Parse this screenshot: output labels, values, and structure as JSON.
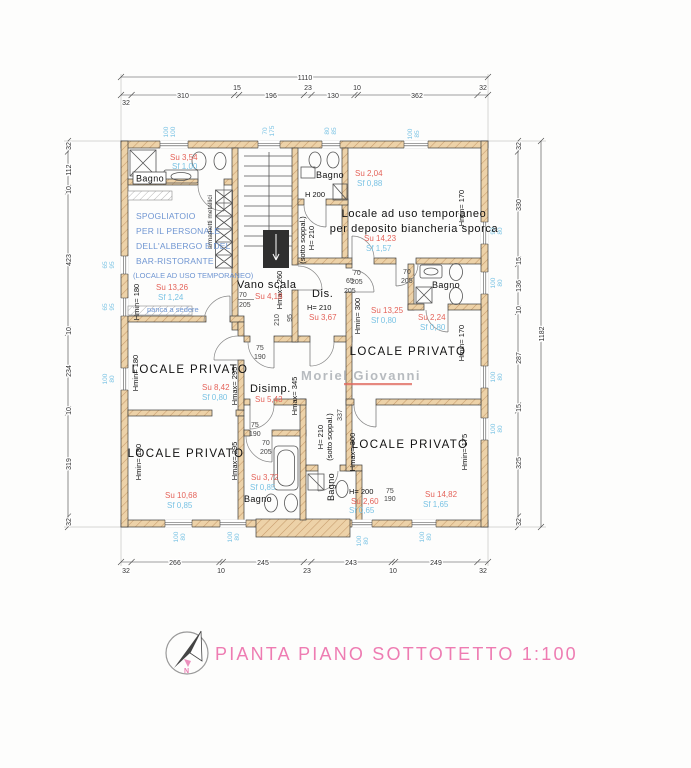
{
  "colors": {
    "wall_fill": "#edd2a8",
    "wall_hatch": "#c59a6a",
    "su_red": "#e4635a",
    "sf_cyan": "#7ac3e4",
    "desc_blue": "#7096d2",
    "title_pink": "#ee7cb2",
    "watermark_gray": "#a6abb1"
  },
  "title": "PIANTA PIANO SOTTOTETTO 1:100",
  "watermark": "Moriel Giovanni",
  "logo_n": "N",
  "dims": {
    "top": {
      "overall": "1110",
      "segs": [
        "32",
        "310",
        "15",
        "196",
        "23",
        "130",
        "10",
        "362",
        "32"
      ]
    },
    "bottom": {
      "segs": [
        "32",
        "266",
        "10",
        "245",
        "23",
        "243",
        "10",
        "249",
        "32"
      ]
    },
    "left": {
      "segs": [
        "32",
        "112",
        "10",
        "423",
        "10",
        "234",
        "10",
        "319",
        "32"
      ]
    },
    "right": {
      "overall": "1182",
      "segs": [
        "32",
        "330",
        "15",
        "136",
        "10",
        "287",
        "15",
        "325",
        "32"
      ]
    }
  },
  "rooms": {
    "bagno_tl": {
      "name": "Bagno",
      "su": "Su 3,54",
      "sf": "Sf 1,00"
    },
    "spogliatoio": {
      "line1": "SPOGLIATOIO",
      "line2": "PER IL PERSONALE",
      "line3": "DELL'ALBERGO E DEL",
      "line4": "BAR-RISTORANTE",
      "line5": "(LOCALE AD USO TEMPORANEO)",
      "su": "Su 13,26",
      "sf": "Sf 1,24",
      "bench": "panca a sedere",
      "lockers": "armadietti metallici",
      "hmin": "Hmin= 180",
      "hmax": "Hmax= 260"
    },
    "vano_scala": {
      "name": "Vano scala",
      "su": "Su 4,18"
    },
    "dis": {
      "name": "Dis.",
      "h": "H= 210",
      "su": "Su 3,67"
    },
    "bagno_tc": {
      "name": "Bagno",
      "h": "H 200",
      "su": "Su 2,04",
      "sf": "Sf 0,88"
    },
    "corridoio_tc": {
      "h": "H= 210",
      "note": "(sotto soppal.)"
    },
    "deposito": {
      "line1": "Locale ad uso temporaneo",
      "line2": "per deposito biancheria sporca",
      "su": "Su 14,23",
      "sf": "Sf 1,57",
      "hmin": "Hmin= 170"
    },
    "bagno_r": {
      "name": "Bagno",
      "su": "Su 2,24",
      "sf": "Sf 0,80"
    },
    "locale_rm": {
      "name": "LOCALE PRIVATO",
      "su": "Su 13,25",
      "sf": "Sf 0,80",
      "hmin_left": "Hmin= 300",
      "hmin_right": "Hmin= 170"
    },
    "locale_ml": {
      "name": "LOCALE PRIVATO",
      "su": "Su 8,42",
      "sf": "Sf 0,80",
      "hmin": "Hmin= 180",
      "hmax": "Hmax= 295"
    },
    "disimp": {
      "name": "Disimp.",
      "su": "Su 5,43",
      "hmax": "Hmax= 345"
    },
    "locale_bl": {
      "name": "LOCALE PRIVATO",
      "su": "Su 10,68",
      "sf": "Sf 0,85",
      "hmin": "Hmin= 180",
      "hmax": "Hmax= 295"
    },
    "bagno_bc": {
      "name": "Bagno",
      "su": "Su 3,72",
      "sf": "Sf 0,85"
    },
    "bagno_br": {
      "name": "Bagno",
      "h": "H= 200",
      "su": "Su 2,60",
      "sf": "Sf 0,65"
    },
    "locale_br": {
      "name": "LOCALE PRIVATO",
      "su": "Su 14,82",
      "sf": "Sf 1,65",
      "hmax": "Hmax= 300",
      "hmin": "Hmin= 175",
      "corr_h": "H= 210",
      "corr_note": "(sotto soppal.)",
      "corr_dim": "337"
    }
  },
  "doors": {
    "d70x205": {
      "w": "70",
      "h": "205"
    },
    "d75x190": {
      "w": "75",
      "h": "190"
    },
    "d65x205": {
      "w": "65",
      "h": "205"
    },
    "d95x210": {
      "w": "95",
      "h": "210"
    }
  },
  "windows": {
    "w100x100": {
      "a": "100",
      "b": "100"
    },
    "w70x175": {
      "a": "70",
      "b": "175"
    },
    "w80x85": {
      "a": "80",
      "b": "85"
    },
    "w100x85": {
      "a": "100",
      "b": "85"
    },
    "w90x80": {
      "a": "90",
      "b": "80"
    },
    "w65x95": {
      "a": "65",
      "b": "95"
    },
    "w100x80": {
      "a": "100",
      "b": "80"
    }
  }
}
